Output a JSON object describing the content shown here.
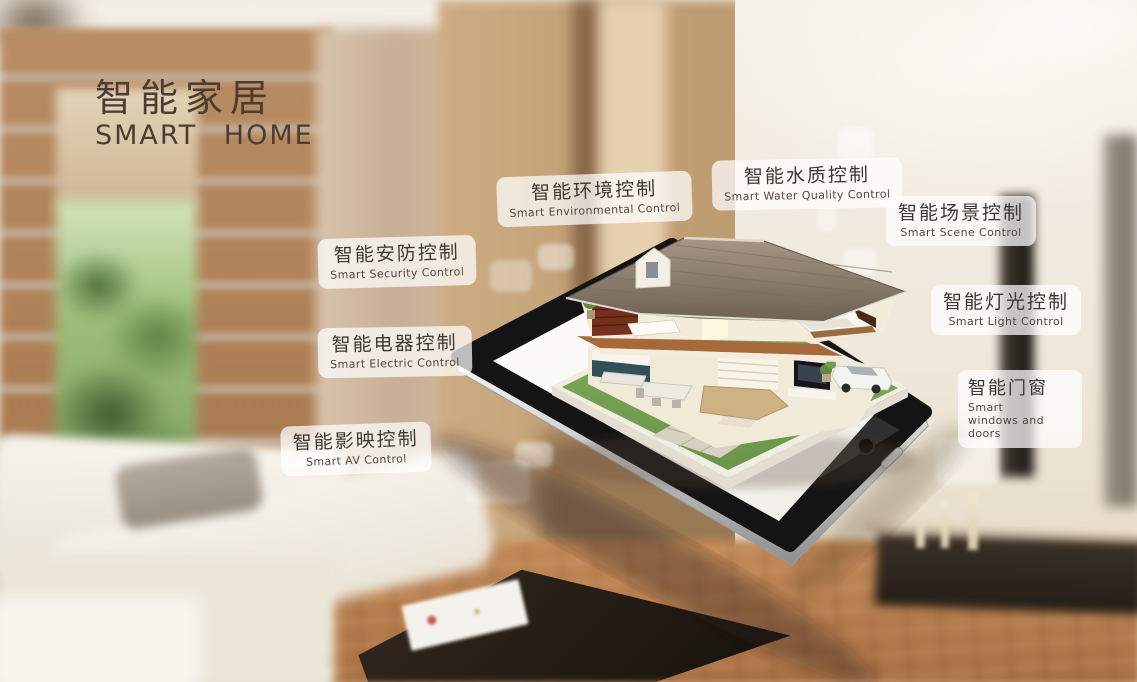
{
  "title": {
    "zh": "智能家居",
    "en": "SMART HOME"
  },
  "labels": [
    {
      "id": "environment",
      "zh": "智能环境控制",
      "en": "Smart Environmental Control"
    },
    {
      "id": "water-quality",
      "zh": "智能水质控制",
      "en": "Smart Water Quality Control"
    },
    {
      "id": "scene",
      "zh": "智能场景控制",
      "en": "Smart Scene Control"
    },
    {
      "id": "security",
      "zh": "智能安防控制",
      "en": "Smart Security Control"
    },
    {
      "id": "light",
      "zh": "智能灯光控制",
      "en": "Smart Light Control"
    },
    {
      "id": "electric",
      "zh": "智能电器控制",
      "en": "Smart Electric Control"
    },
    {
      "id": "windows-doors",
      "zh": "智能门窗",
      "en": "Smart windows and doors"
    },
    {
      "id": "av",
      "zh": "智能影映控制",
      "en": "Smart AV Control"
    }
  ],
  "colors": {
    "title_text": "#4a3e33",
    "label_background": "rgba(255,255,255,0.72)",
    "label_text_zh": "#3c3833",
    "label_text_en": "#52483e",
    "tablet_bezel": "#141414",
    "tablet_screen": "#ffffff",
    "roof": "#8d7e70",
    "lawn": "#7aa457",
    "wood_wall": "#b08157",
    "floor_wood": "#b5784a"
  }
}
